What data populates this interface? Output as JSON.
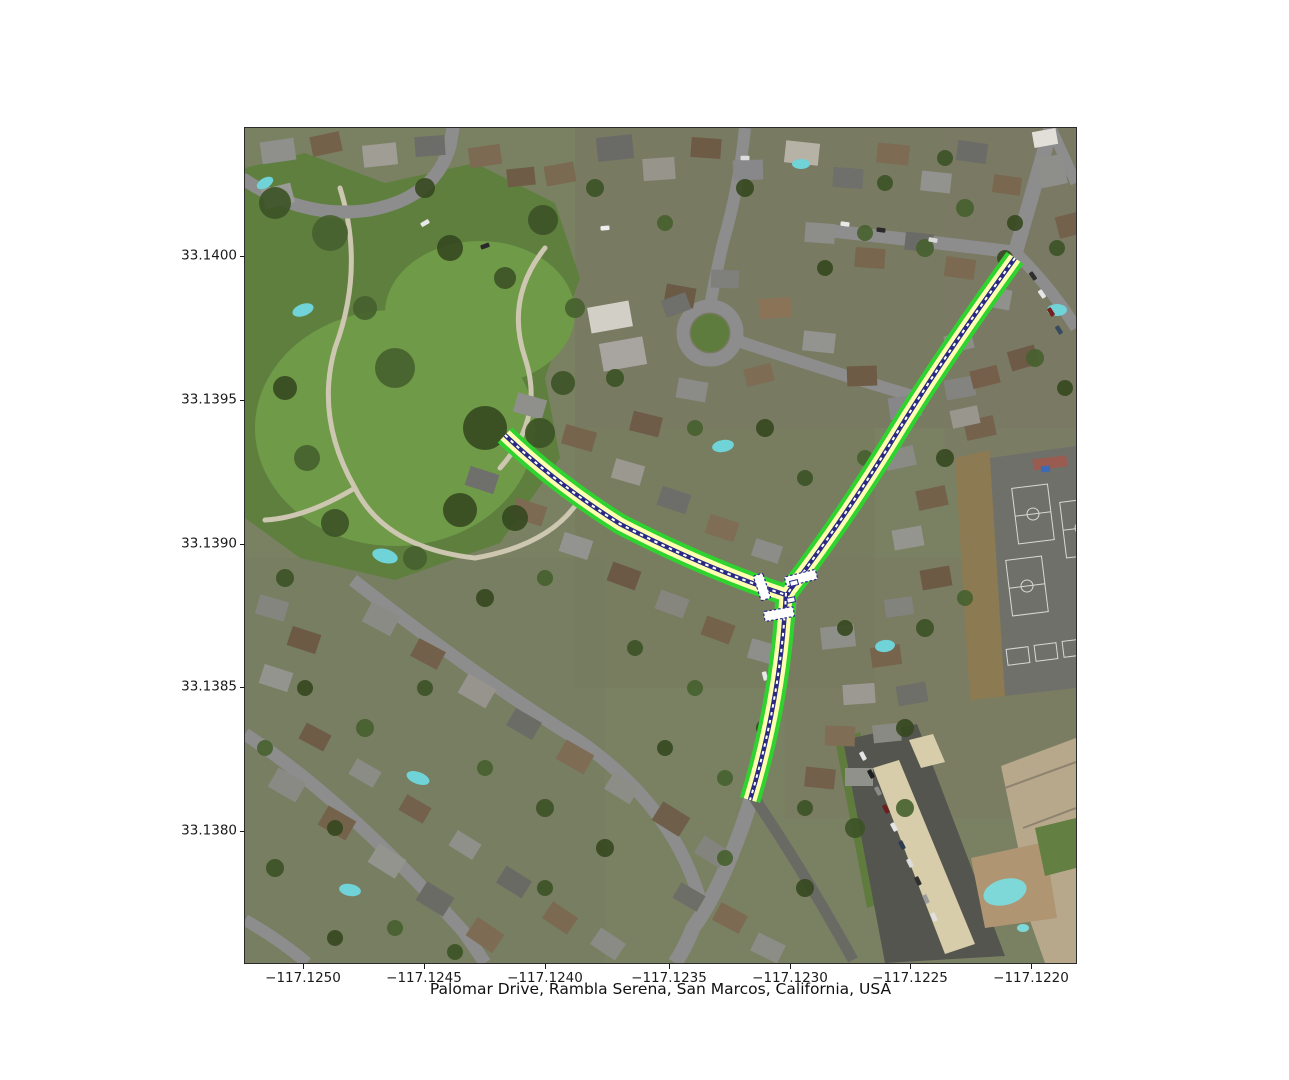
{
  "figure": {
    "title": "Palomar Drive, Rambla Serena, San Marcos, California, USA"
  },
  "axes": {
    "x_tick_labels": [
      "−117.1250",
      "−117.1245",
      "−117.1240",
      "−117.1235",
      "−117.1230",
      "−117.1225",
      "−117.1220"
    ],
    "y_tick_labels": [
      "33.1400",
      "33.1395",
      "33.1390",
      "33.1385",
      "33.1380"
    ]
  },
  "map": {
    "type": "satellite-imagery",
    "highlighted_street": "Palomar Drive",
    "area": "Rambla Serena, San Marcos, California, USA",
    "route_overlay": {
      "edge_color": "#2fd32f",
      "fill_color": "#ffffb0",
      "centerline_color": "#2a2a85",
      "centerline_dash_color": "#ffffff",
      "branches": [
        "northeast",
        "west",
        "south"
      ],
      "junction_type": "T-intersection with white crossing markers"
    }
  }
}
